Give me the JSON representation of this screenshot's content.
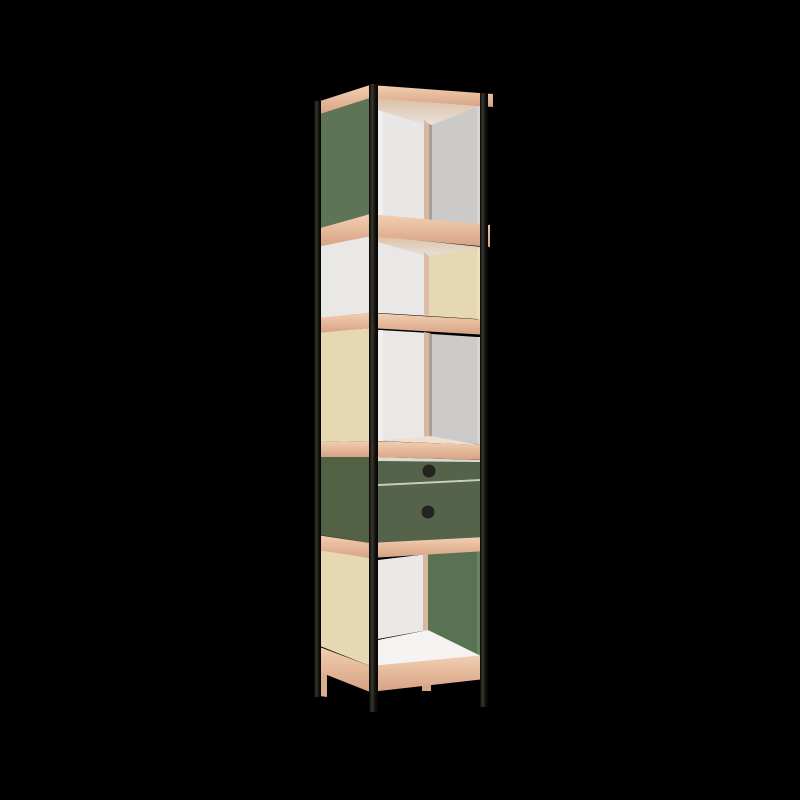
{
  "scene": {
    "background_color": "#000000",
    "width": 800,
    "height": 800,
    "subject": "Tall narrow column shelving unit, three-quarter perspective view"
  },
  "furniture": {
    "type": "tower-shelf",
    "frame": "thin black metal corner posts with legs",
    "shelf_edges": "light plywood",
    "drawer_count": 2,
    "knob_color": "#24231f",
    "sections": [
      {
        "id": "bay-1-top",
        "kind": "open shelf",
        "side_panel": "green",
        "back_wall": "white",
        "right_wall": "grey"
      },
      {
        "id": "bay-2",
        "kind": "open shelf",
        "side_panel": "white",
        "back_wall": "white",
        "right_wall": "cream"
      },
      {
        "id": "bay-3",
        "kind": "open shelf",
        "side_panel": "cream",
        "back_wall": "white",
        "right_wall": "grey"
      },
      {
        "id": "drawer-unit",
        "kind": "two drawers",
        "side_panel": "green",
        "front": "green",
        "knobs": "round black"
      },
      {
        "id": "bay-4-bottom",
        "kind": "open shelf",
        "side_panel": "cream",
        "back_wall": "white",
        "right_wall": "green",
        "floor": "white"
      }
    ],
    "palette": {
      "green_side": "#5e7456",
      "green_drawer": "#546349",
      "green_wall": "#597253",
      "cream": "#e6d8b3",
      "white_panel": "#e9e8e6",
      "back_white": "#eae8e6",
      "grey_wall": "#cbcac8",
      "floor_white": "#f4f3f1",
      "wood_light": "#f2cfb3",
      "wood_dark": "#d7a284",
      "metal": "#15140f"
    }
  },
  "render": {
    "shapes": [
      {
        "name": "bay1-ceiling",
        "type": "polygon",
        "points": "378,98 482,106 430,127 378,114",
        "fill": "url(#gradCeil)"
      },
      {
        "name": "bay1-back-wall",
        "type": "polygon",
        "points": "378,110 430,126 430,221 378,215",
        "fill": "#e9e7e5"
      },
      {
        "name": "bay1-left-sliver",
        "type": "polygon",
        "points": "378,110 383,112 383,216 378,215",
        "fill": "#f2f0ee"
      },
      {
        "name": "bay1-corner-wood-strip",
        "type": "polygon",
        "points": "424,120 429,124 429,221 424,219",
        "fill": "#d8b79f"
      },
      {
        "name": "bay1-corner-edge",
        "type": "polygon",
        "points": "429,124 432,125 432,221 429,221",
        "fill": "#a59d98"
      },
      {
        "name": "bay1-right-wall",
        "type": "polygon",
        "points": "432,125 477,107 477,225 432,221",
        "fill": "#cbcac8"
      },
      {
        "name": "bay1-right-edge",
        "type": "polygon",
        "points": "477,107 481,106 481,226 477,225",
        "fill": "#d8d6d4"
      },
      {
        "name": "bay2-ceiling",
        "type": "polygon",
        "points": "378,236 482,247 430,258 378,244",
        "fill": "url(#gradCeil)"
      },
      {
        "name": "bay2-back-wall",
        "type": "polygon",
        "points": "378,242 430,257 430,316 378,313",
        "fill": "#eae8e6"
      },
      {
        "name": "bay2-corner-wood-strip",
        "type": "polygon",
        "points": "424,252 429,256 429,316 424,314",
        "fill": "#dcbca4"
      },
      {
        "name": "bay2-right-wall",
        "type": "polygon",
        "points": "429,256 477,248 477,319 429,316",
        "fill": "#e6d8b3"
      },
      {
        "name": "bay2-right-edge",
        "type": "polygon",
        "points": "477,248 481,247 481,320 477,319",
        "fill": "#eee1c2"
      },
      {
        "name": "bay3-back-wall",
        "type": "polygon",
        "points": "378,330 430,333 430,437 378,441",
        "fill": "#eae8e6"
      },
      {
        "name": "bay3-left-sliver",
        "type": "polygon",
        "points": "378,330 383,330 383,441 378,441",
        "fill": "#f2f0ee"
      },
      {
        "name": "bay3-corner-wood-strip",
        "type": "polygon",
        "points": "424,332 429,333 429,437 424,438",
        "fill": "#d8b79f"
      },
      {
        "name": "bay3-corner-edge",
        "type": "polygon",
        "points": "429,333 432,334 432,437 429,437",
        "fill": "#a59d98"
      },
      {
        "name": "bay3-right-wall",
        "type": "polygon",
        "points": "432,334 477,337 477,444 432,437",
        "fill": "#cccbc9"
      },
      {
        "name": "bay3-right-edge",
        "type": "polygon",
        "points": "477,337 481,337 481,445 477,444",
        "fill": "#d8d6d4"
      },
      {
        "name": "bay3-floor-sliver",
        "type": "polygon",
        "points": "378,441 430,436 482,445",
        "fill": "#eedfd0"
      },
      {
        "name": "bay4-back-wall",
        "type": "polygon",
        "points": "378,560 428,554 428,630 378,639",
        "fill": "#eae8e6"
      },
      {
        "name": "bay4-corner-wood-strip",
        "type": "polygon",
        "points": "423,555 428,554 428,630 423,633",
        "fill": "#d8b79f"
      },
      {
        "name": "bay4-right-wall",
        "type": "polygon",
        "points": "428,554 477,551 477,657 428,630",
        "fill": "#597253"
      },
      {
        "name": "bay4-right-edge",
        "type": "polygon",
        "points": "477,551 481,551 481,657 477,657",
        "fill": "#6b8362"
      },
      {
        "name": "bay4-floor",
        "type": "polygon",
        "points": "378,666 481,656 428,630 378,640",
        "fill": "#f4f3f1"
      },
      {
        "name": "drawer-top-gap",
        "type": "polygon",
        "points": "378,457 480,460 480,463 378,462",
        "fill": "#dadcd3"
      },
      {
        "name": "drawer-1-front",
        "type": "polygon",
        "points": "378,461 480,462 480,479 378,484",
        "fill": "#546349"
      },
      {
        "name": "drawer-divider-gap",
        "type": "polygon",
        "points": "378,484 480,479 480,482 378,487",
        "fill": "#c9d0c3"
      },
      {
        "name": "drawer-2-front",
        "type": "polygon",
        "points": "378,486 480,481 480,538 378,543",
        "fill": "#546349"
      },
      {
        "name": "drawer-1-knob",
        "type": "circle",
        "cx": 429,
        "cy": 471,
        "r": 6.5,
        "fill": "#24231f"
      },
      {
        "name": "drawer-2-knob",
        "type": "circle",
        "cx": 428,
        "cy": 512,
        "r": 6.5,
        "fill": "#24231f"
      },
      {
        "name": "side-panel-1-green",
        "type": "polygon",
        "points": "320,114 370,98 370,214 320,229",
        "fill": "#5e7456"
      },
      {
        "name": "side-panel-2-white",
        "type": "polygon",
        "points": "320,246 370,236 370,313 320,318",
        "fill": "#e9e8e6"
      },
      {
        "name": "side-panel-3-cream",
        "type": "polygon",
        "points": "320,332 370,328 370,441 320,442",
        "fill": "#e6d8b3"
      },
      {
        "name": "side-panel-4-green",
        "type": "polygon",
        "points": "320,456 370,457 370,543 320,535",
        "fill": "#526044"
      },
      {
        "name": "side-panel-5-cream",
        "type": "polygon",
        "points": "320,549 370,558 370,666 320,646",
        "fill": "#e6d8b3"
      },
      {
        "name": "back-foot-wood",
        "type": "rect",
        "x": 422,
        "y": 681,
        "w": 9,
        "h": 10,
        "fill": "#d5a685"
      },
      {
        "name": "left-foot-wood",
        "type": "polygon",
        "points": "320,671 327,673 327,697 320,696",
        "fill": "#dcae90"
      },
      {
        "name": "top-slab-left-edge",
        "type": "polygon",
        "points": "317,102 370,85 370,98 317,115",
        "fill": "url(#gradWood)"
      },
      {
        "name": "top-slab-front-edge",
        "type": "polygon",
        "points": "370,85 493,94 493,107 370,98",
        "fill": "url(#gradWood)"
      },
      {
        "name": "shelf-1-left-edge",
        "type": "polygon",
        "points": "317,229 370,214 370,236 317,247",
        "fill": "url(#gradWood)"
      },
      {
        "name": "shelf-1-front-edge",
        "type": "polygon",
        "points": "370,214 490,225 490,247 370,236",
        "fill": "url(#gradWood)"
      },
      {
        "name": "shelf-2-left-edge",
        "type": "polygon",
        "points": "317,318 370,313 370,328 317,333",
        "fill": "url(#gradWood)"
      },
      {
        "name": "shelf-2-front-edge",
        "type": "polygon",
        "points": "370,313 488,320 488,335 370,328",
        "fill": "url(#gradWood)"
      },
      {
        "name": "shelf-3-left-edge",
        "type": "polygon",
        "points": "317,442 370,441 370,457 317,457",
        "fill": "url(#gradWood)"
      },
      {
        "name": "shelf-3-front-edge",
        "type": "polygon",
        "points": "370,441 487,445 487,460 370,457",
        "fill": "url(#gradWood)"
      },
      {
        "name": "shelf-4-left-edge",
        "type": "polygon",
        "points": "317,535 370,543 370,558 317,550",
        "fill": "url(#gradWood)"
      },
      {
        "name": "shelf-4-front-edge",
        "type": "polygon",
        "points": "370,543 486,537 486,551 370,558",
        "fill": "url(#gradWood)"
      },
      {
        "name": "base-left-edge",
        "type": "polygon",
        "points": "317,646 370,666 370,692 317,671",
        "fill": "url(#gradWood)"
      },
      {
        "name": "base-front-edge",
        "type": "polygon",
        "points": "370,666 485,655 485,679 370,692",
        "fill": "url(#gradWood)"
      },
      {
        "name": "post-left",
        "type": "rect",
        "x": 314,
        "y": 101,
        "w": 7,
        "h": 596,
        "fill": "url(#gradMetal)"
      },
      {
        "name": "post-front",
        "type": "rect",
        "x": 369,
        "y": 84,
        "w": 9,
        "h": 628,
        "fill": "url(#gradMetal)"
      },
      {
        "name": "post-right",
        "type": "rect",
        "x": 480,
        "y": 93,
        "w": 8,
        "h": 614,
        "fill": "url(#gradMetal)"
      }
    ]
  }
}
